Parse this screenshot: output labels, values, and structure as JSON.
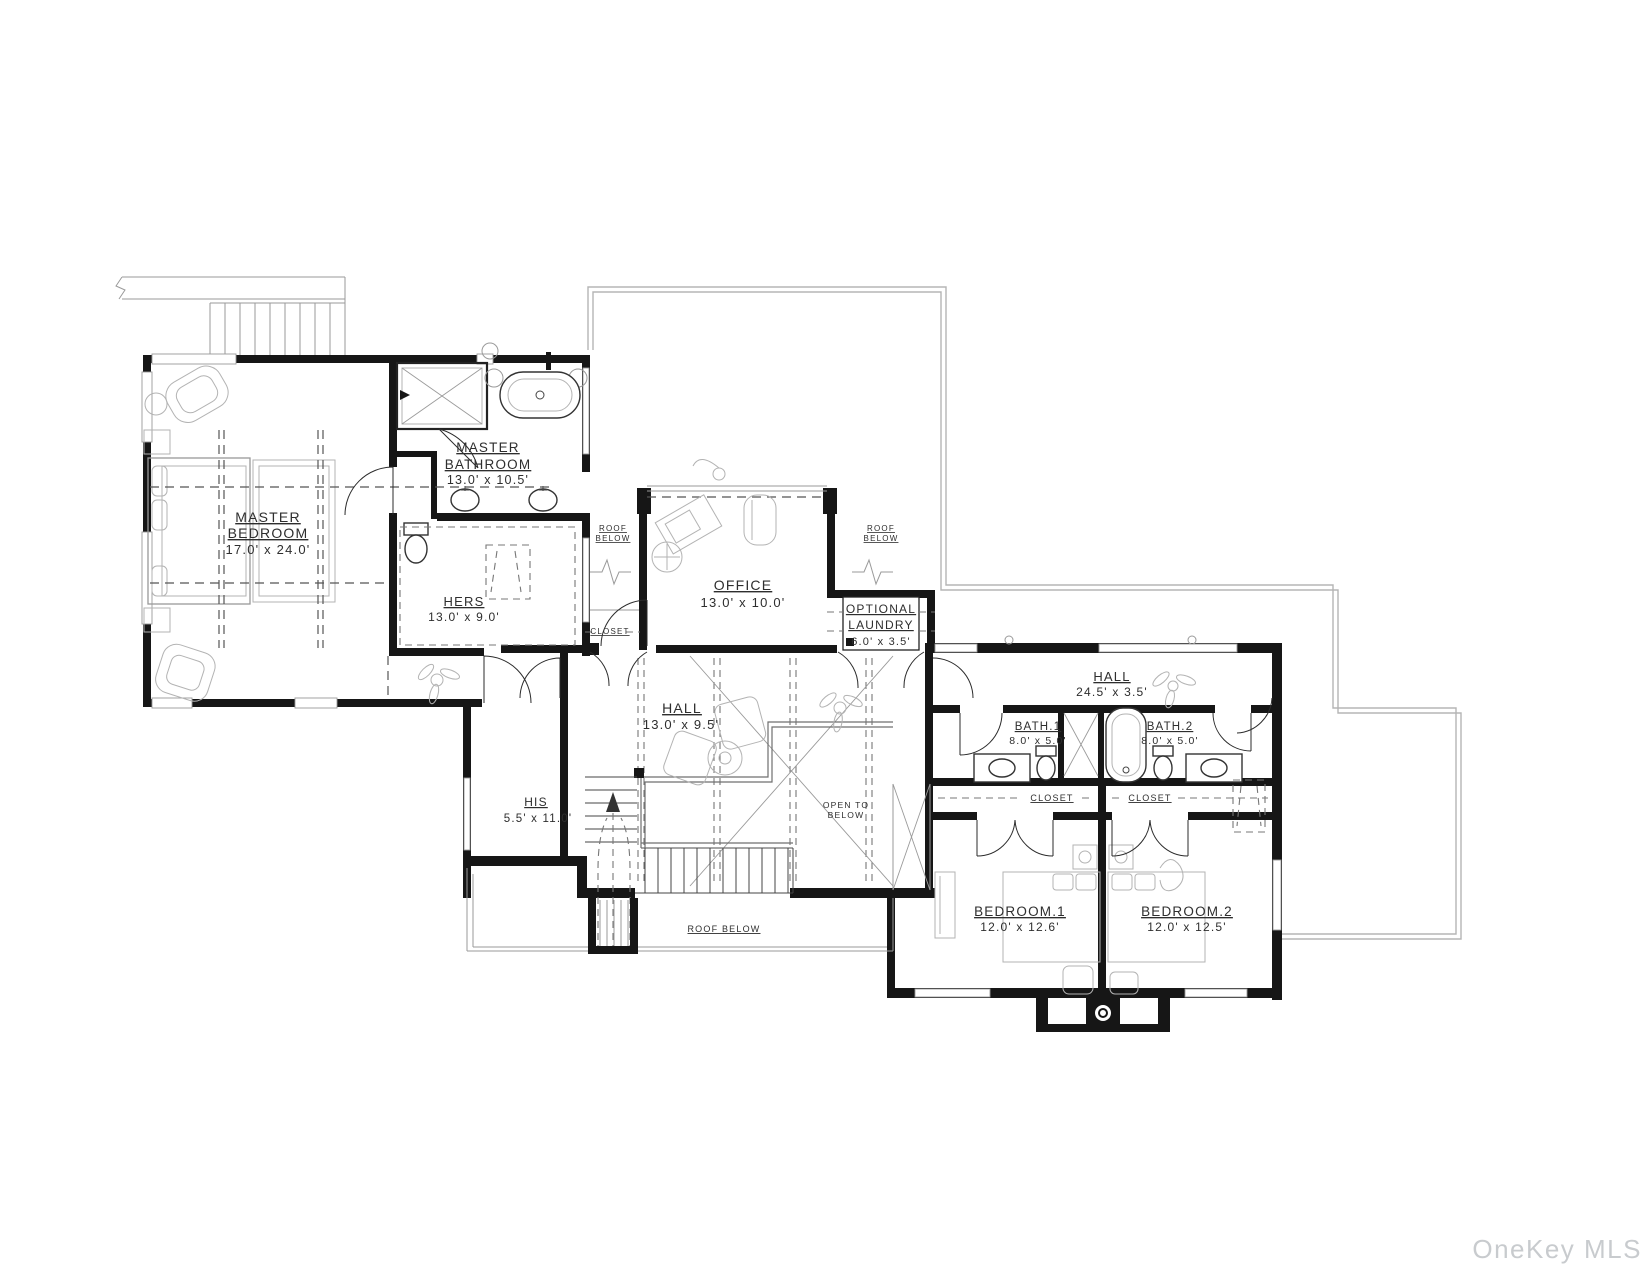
{
  "plan": {
    "rooms": {
      "master_bedroom": {
        "name1": "MASTER",
        "name2": "BEDROOM",
        "dims": "17.0' x 24.0'"
      },
      "master_bathroom": {
        "name1": "MASTER",
        "name2": "BATHROOM",
        "dims": "13.0' x 10.5'"
      },
      "hers_closet": {
        "name": "HERS",
        "dims": "13.0' x 9.0'"
      },
      "his_closet": {
        "name": "HIS",
        "dims": "5.5' x 11.0'"
      },
      "office": {
        "name": "OFFICE",
        "dims": "13.0' x 10.0'"
      },
      "optional_laundry": {
        "name1": "OPTIONAL",
        "name2": "LAUNDRY",
        "dims": "6.0' x 3.5'"
      },
      "hall_center": {
        "name": "HALL",
        "dims": "13.0' x 9.5'"
      },
      "hall_bedroom_wing": {
        "name": "HALL",
        "dims": "24.5' x 3.5'"
      },
      "bath_1": {
        "name": "BATH.1",
        "dims": "8.0' x 5.0'"
      },
      "bath_2": {
        "name": "BATH.2",
        "dims": "8.0' x 5.0'"
      },
      "bedroom_1": {
        "name": "BEDROOM.1",
        "dims": "12.0' x 12.6'"
      },
      "bedroom_2": {
        "name": "BEDROOM.2",
        "dims": "12.0' x 12.5'"
      }
    },
    "annotations": {
      "closet": "CLOSET",
      "roof_word1": "ROOF",
      "roof_word2": "BELOW",
      "roof_below": "ROOF BELOW",
      "open_below_line1": "OPEN TO",
      "open_below_line2": "BELOW"
    },
    "watermark": "OneKey MLS",
    "colors": {
      "walls": "#161616",
      "furniture": "#999999",
      "roof_outline": "#b5b5b5",
      "text": "#2e2e2e",
      "watermark": "#c8cbce",
      "background": "#ffffff"
    }
  }
}
